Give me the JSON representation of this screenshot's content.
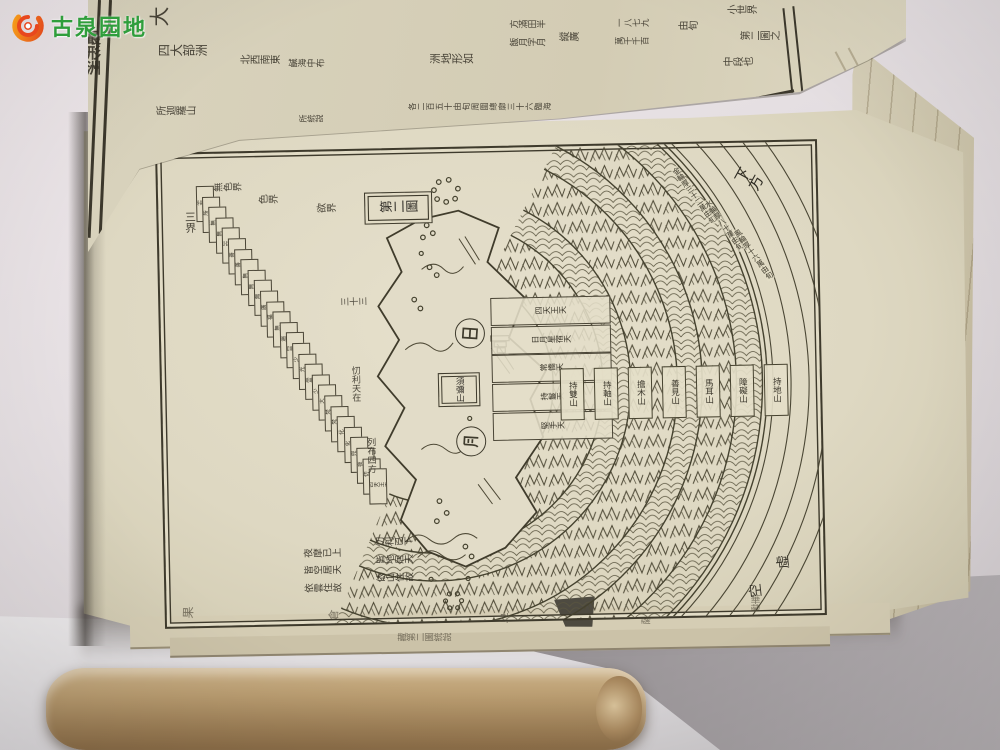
{
  "watermark": {
    "site_name": "古泉园地",
    "icon": "coin-swirl-icon"
  },
  "prev_page": {
    "edge_title": "最形洲",
    "heading": "大",
    "continents_label": "四大部洲",
    "directions": "北西南東",
    "sea_note": "鹹海中布",
    "ring_mountain": "所迦羅山",
    "note": "所統說",
    "shape_label": "洲地形如",
    "shape_items": [
      "方滿田半",
      "飯月字月"
    ],
    "extent_label": "縱廣",
    "figures": [
      "一八七九",
      "萬千千百"
    ],
    "unit": "由旬",
    "measure_row": "各二百五十由旬周圍總廓三十六臨海",
    "right_caption": [
      "小世界",
      "第二圖之",
      "中段也"
    ]
  },
  "diagram": {
    "title": "第二圖",
    "down_label": "下方",
    "void_a": "虛",
    "void_b": "空",
    "sun": "日",
    "moon": "月",
    "sumeru_label": "須彌山",
    "realm_three": "三界",
    "realm_formless": "無色界",
    "realm_form": "色界",
    "realm_desire": "欲界",
    "heavens": [
      "非想非非想天",
      "無所有處天",
      "識無邊處天",
      "空無邊處天",
      "色究竟天",
      "善現天",
      "善見天",
      "無熱天",
      "無煩天",
      "無想天",
      "廣果天",
      "福生天",
      "無雲天",
      "遍淨天",
      "無量淨天",
      "少淨天",
      "光音天",
      "無量光天",
      "少光天",
      "大梵天",
      "梵輔天",
      "梵眾天",
      "他化自在天",
      "化樂天",
      "兜率天",
      "夜摩天",
      "忉利天",
      "四天王天"
    ],
    "terraces": [
      "四天王天",
      "日月星宿天",
      "常憍天",
      "持鬘天",
      "堅手天"
    ],
    "seven_mountains": [
      "持雙山",
      "持軸山",
      "擔木山",
      "善見山",
      "馬耳山",
      "障礙山",
      "持地山"
    ],
    "wheel_bands": [
      "金輪厚三十二萬由旬",
      "水輪厚八十萬由旬",
      "風輪厚十六萬由旬"
    ],
    "note_sky": [
      "夜摩已上",
      "皆空居天",
      "依雲住故"
    ],
    "note_earth": [
      "忉利已下",
      "皆地居天",
      "依山住故"
    ],
    "note_summit": [
      "忉利天在",
      "列布四方"
    ],
    "thirty_three": "三十三"
  },
  "bottom_edge": {
    "glyphs": [
      "果",
      "倉",
      "早",
      "薩"
    ],
    "caption": "藏第二圖統說",
    "corner": "華藏"
  }
}
